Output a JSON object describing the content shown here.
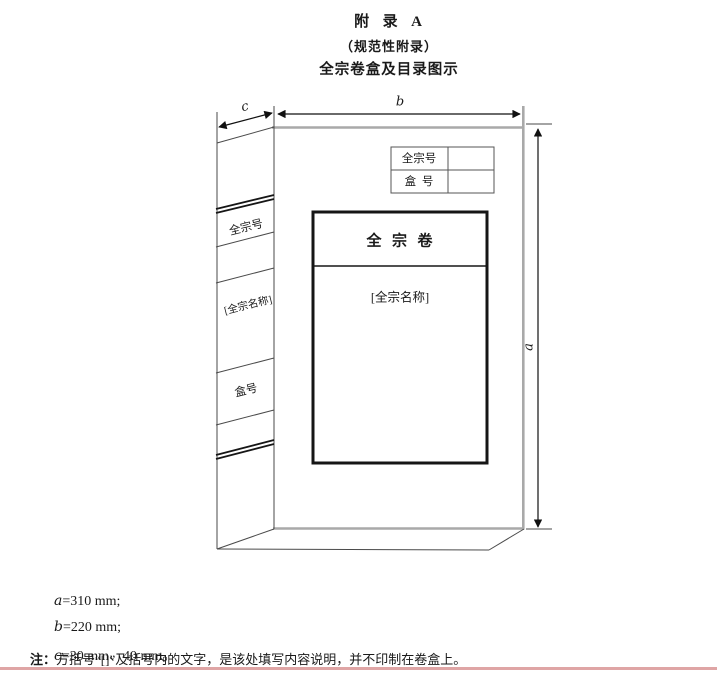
{
  "page": {
    "footer_rule_style": "background:#dfa5a5"
  },
  "header": {
    "title": "附  录  A",
    "subtitle": "（规范性附录）",
    "caption": "全宗卷盒及目录图示"
  },
  "diagram": {
    "spine": {
      "fond_number": "全宗号",
      "fond_name": "[全宗名称]",
      "box_number": "盒号"
    },
    "corner_table": {
      "row1_label": "全宗号",
      "row2_label": "盒  号"
    },
    "card": {
      "title": "全  宗  卷",
      "body": "[全宗名称]"
    },
    "dim_labels": {
      "a": "a",
      "b": "b",
      "c": "c"
    }
  },
  "legend": {
    "dims": [
      {
        "var": "a",
        "rest": "=310 mm;"
      },
      {
        "var": "b",
        "rest": "=220 mm;"
      },
      {
        "var": "c",
        "rest": "=30 mm、40 mm。"
      }
    ],
    "note_prefix": "注：",
    "note_text": "方括号“[]”及括号内的文字，是该处填写内容说明，并不印制在卷盒上。"
  }
}
